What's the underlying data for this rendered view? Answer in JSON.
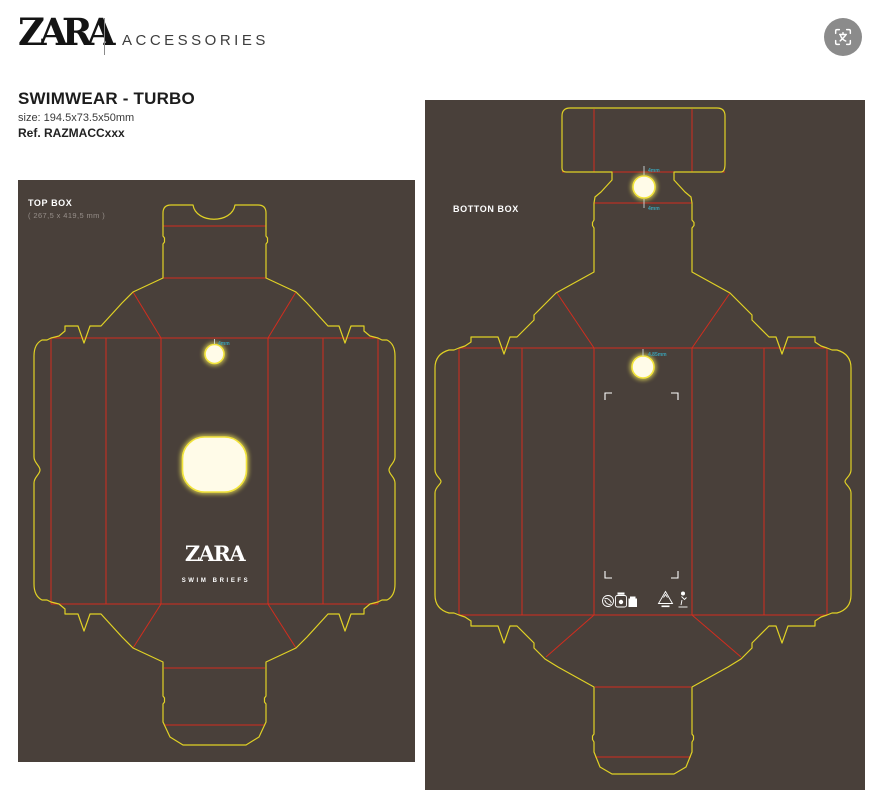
{
  "header": {
    "brand": "ZARA",
    "section": "ACCESSORIES"
  },
  "title": {
    "product": "SWIMWEAR - TURBO",
    "size": "size: 194.5x73.5x50mm",
    "reference": "Ref. RAZMACCxxx"
  },
  "top_box": {
    "label": "TOP BOX",
    "dimensions": "( 267,5 x 419,5 mm )",
    "annotation_hole": "4mm",
    "logo": "ZARA",
    "product_line": "SWIM BRIEFS"
  },
  "bottom_box": {
    "label": "BOTTON BOX",
    "annotation_top": "4mm",
    "annotation_mid": "4mm",
    "annotation_hole": "4.85mm"
  },
  "colors": {
    "cut_line": "#e0d125",
    "crease_line": "#d22d1e",
    "panel_background": "#49403a",
    "annotation_text": "#3aa0b4"
  }
}
